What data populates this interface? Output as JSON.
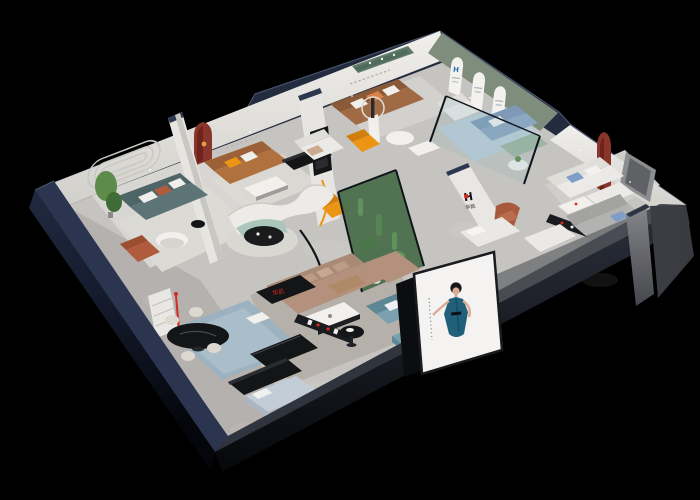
{
  "scene": {
    "type": "isometric-3d-showroom-cutaway-render",
    "description": "furniture showroom dollhouse view on black backdrop"
  },
  "brand": {
    "logo_symbol": "H",
    "logo_name": "华凯",
    "arch_logo_symbol": "H"
  },
  "palette": {
    "bg": "#000000",
    "wall_top": "#232b3e",
    "wall_top_light": "#2e3750",
    "wall_white": "#eceae6",
    "wall_shade": "#d6d4cf",
    "ext_navy": "#1b2234",
    "ext_navy_deep": "#0a0d16",
    "ext_gray": "#6e7076",
    "ext_gray_dark": "#3b3d42",
    "floor_main": "#c6c4c0",
    "floor_light": "#d8d6d2",
    "rug_light": "#dcdad4",
    "rug_blue": "#9cb2c0",
    "rug_sky": "#bccdd8",
    "rug_center": "#b5b1aa",
    "green_wall": "#7e8d7c",
    "arch_white": "#f3f2ef",
    "red_arch": "#8a352b",
    "red_arch_dark": "#6e241d",
    "red_accent": "#d22b20",
    "orange": "#ec9413",
    "rust": "#b05c3c",
    "sofa_teal": "#5d7476",
    "sofa_teal_dark": "#4e6567",
    "sofa_caramel": "#b0713f",
    "sofa_caramel_dark": "#9c6136",
    "sofa_brown": "#9f6a44",
    "sofa_brown_dark": "#8a5a38",
    "sofa_tan": "#b4917c",
    "sofa_tan_dark": "#a88a76",
    "pillow_tan": "#c7a78f",
    "sofa_mint": "#abc7bb",
    "sofa_blue": "#8ca7c1",
    "sofa_blue_dark": "#7e9ab8",
    "sofa_sage": "#9db4a0",
    "sofa_steel": "#7ba0af",
    "sofa_steel_dark": "#5d8795",
    "sofa_white": "#eceae7",
    "sofa_white_dark": "#e0ded9",
    "sofa_gray": "#b2b2b0",
    "black_furn": "#141517",
    "black_furn_hi": "#2c2d31",
    "table_white": "#f1f0ed",
    "glass": "#7fb3b8",
    "frame_dark": "#10141c",
    "plant": "#5d8c4a",
    "plant_dark": "#3f6b35",
    "planter_floor": "#3f5e33",
    "pebble": "#e8e8e4",
    "poster_bg": "#f4f3f1",
    "skin": "#d9ab92",
    "hair": "#15151a",
    "dress_teal": "#20607a",
    "dress_teal_dark": "#184e63",
    "blue_logo": "#2e6fb5",
    "gold": "#d9a441",
    "pillow_blue": "#7f9dc9",
    "bed_lavender": "#aab6c4",
    "bed_lavender_top": "#c3cdd8",
    "chair_cream": "#ded9d0"
  }
}
